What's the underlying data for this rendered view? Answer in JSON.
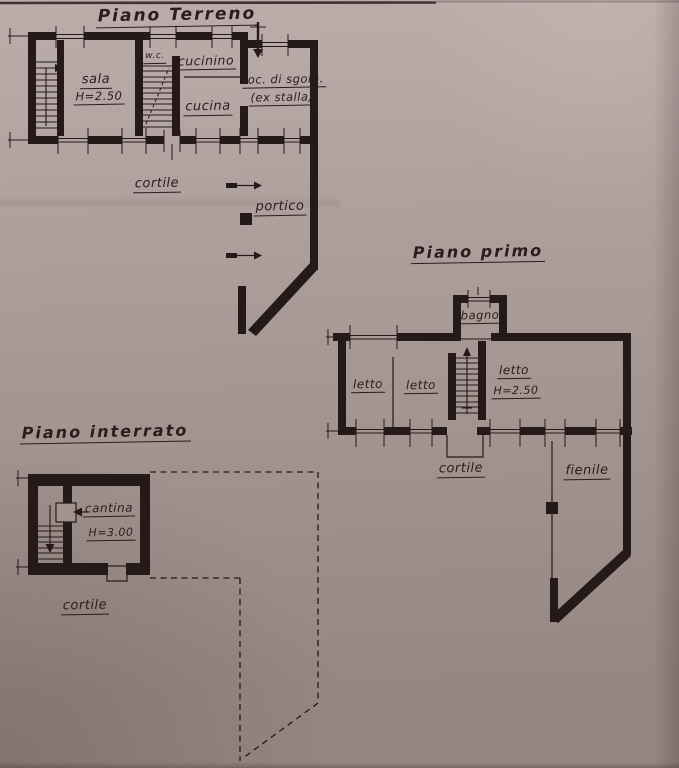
{
  "colors": {
    "ink": "#241a1a",
    "ink-text": "#2a1d1d",
    "paper-a": "#bcadaa",
    "paper-b": "#b0a19e",
    "paper-c": "#a3938f",
    "paper-d": "#968783"
  },
  "plans": {
    "ground": {
      "title": "Piano Terreno",
      "rooms": {
        "sala": "sala",
        "sala_height": "H=2.50",
        "wc": "w.c.",
        "cucinino": "cucinino",
        "cucina": "cucina",
        "sgombero_line1": "loc. di sgom.",
        "sgombero_line2": "(ex stalla)"
      },
      "areas": {
        "cortile": "cortile",
        "portico": "portico"
      }
    },
    "first": {
      "title": "Piano primo",
      "rooms": {
        "bagno": "bagno",
        "letto1": "letto",
        "letto2": "letto",
        "letto3": "letto",
        "letto3_height": "H=2.50"
      },
      "areas": {
        "cortile": "cortile",
        "fienile": "fienile"
      }
    },
    "basement": {
      "title": "Piano interrato",
      "rooms": {
        "cantina": "cantina",
        "cantina_height": "H=3.00"
      },
      "areas": {
        "cortile": "cortile"
      }
    }
  }
}
